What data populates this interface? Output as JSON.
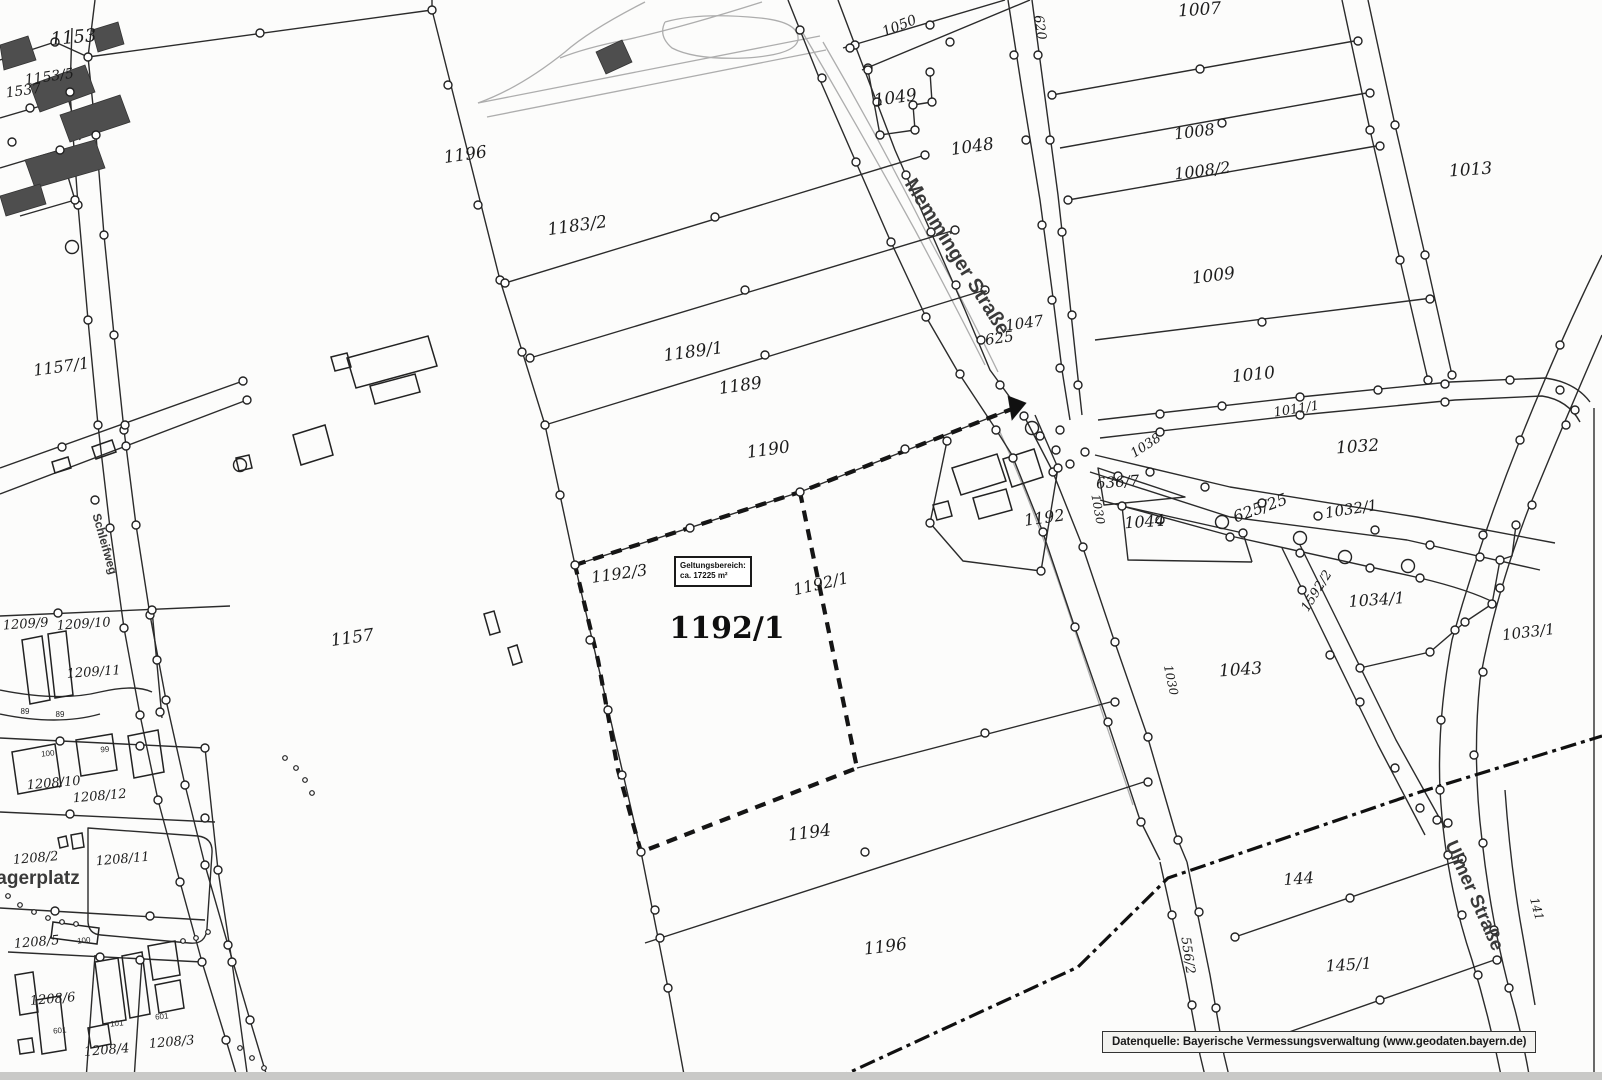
{
  "map": {
    "attribution": "Datenquelle: Bayerische Vermessungsverwaltung (www.geodaten.bayern.de)",
    "geltungsbereich": {
      "line1": "Geltungsbereich:",
      "line2": "ca. 17225 m²"
    },
    "colors": {
      "parcel_line": "#2b2b2b",
      "road_gray": "#adadad",
      "boundary_dashed": "#151515",
      "building_fill": "#4e4e4e"
    },
    "labels": [
      {
        "t": "1153",
        "x": 74,
        "y": 43,
        "r": -5,
        "fs": 18,
        "c": "p"
      },
      {
        "t": "1153/5",
        "x": 50,
        "y": 81,
        "r": -8,
        "fs": 14,
        "c": "p"
      },
      {
        "t": "1537",
        "x": 24,
        "y": 95,
        "r": -8,
        "fs": 14,
        "c": "p"
      },
      {
        "t": "1196",
        "x": 466,
        "y": 160,
        "r": -8,
        "fs": 17,
        "c": "p"
      },
      {
        "t": "1183/2",
        "x": 578,
        "y": 231,
        "r": -8,
        "fs": 17,
        "c": "p"
      },
      {
        "t": "1050",
        "x": 901,
        "y": 30,
        "r": -22,
        "fs": 14,
        "c": "p"
      },
      {
        "t": "1007",
        "x": 1200,
        "y": 15,
        "r": -4,
        "fs": 17,
        "c": "p"
      },
      {
        "t": "1049",
        "x": 896,
        "y": 103,
        "r": -8,
        "fs": 17,
        "c": "p"
      },
      {
        "t": "620",
        "x": 1036,
        "y": 28,
        "r": 82,
        "fs": 13,
        "c": "p"
      },
      {
        "t": "1048",
        "x": 973,
        "y": 152,
        "r": -8,
        "fs": 17,
        "c": "p"
      },
      {
        "t": "1008",
        "x": 1195,
        "y": 137,
        "r": -7,
        "fs": 16,
        "c": "p"
      },
      {
        "t": "1008/2",
        "x": 1203,
        "y": 176,
        "r": -7,
        "fs": 16,
        "c": "p"
      },
      {
        "t": "1013",
        "x": 1471,
        "y": 175,
        "r": -4,
        "fs": 17,
        "c": "p"
      },
      {
        "t": "1009",
        "x": 1214,
        "y": 281,
        "r": -7,
        "fs": 17,
        "c": "p"
      },
      {
        "t": "1010",
        "x": 1254,
        "y": 380,
        "r": -6,
        "fs": 17,
        "c": "p"
      },
      {
        "t": "1047",
        "x": 1025,
        "y": 328,
        "r": -8,
        "fs": 15,
        "c": "p"
      },
      {
        "t": "625",
        "x": 1000,
        "y": 343,
        "r": -8,
        "fs": 15,
        "c": "p"
      },
      {
        "t": "1011/1",
        "x": 1297,
        "y": 413,
        "r": -9,
        "fs": 13,
        "c": "p"
      },
      {
        "t": "1038",
        "x": 1148,
        "y": 449,
        "r": -33,
        "fs": 13,
        "c": "p"
      },
      {
        "t": "1032",
        "x": 1358,
        "y": 452,
        "r": -4,
        "fs": 17,
        "c": "p"
      },
      {
        "t": "625/25",
        "x": 1262,
        "y": 513,
        "r": -20,
        "fs": 16,
        "c": "p"
      },
      {
        "t": "1032/1",
        "x": 1352,
        "y": 514,
        "r": -9,
        "fs": 15,
        "c": "p"
      },
      {
        "t": "636/7",
        "x": 1118,
        "y": 487,
        "r": -4,
        "fs": 15,
        "c": "p"
      },
      {
        "t": "1044",
        "x": 1145,
        "y": 527,
        "r": -4,
        "fs": 16,
        "c": "p"
      },
      {
        "t": "1592/2",
        "x": 1320,
        "y": 593,
        "r": -58,
        "fs": 13,
        "c": "p"
      },
      {
        "t": "1034/1",
        "x": 1377,
        "y": 605,
        "r": -4,
        "fs": 16,
        "c": "p"
      },
      {
        "t": "1033/1",
        "x": 1529,
        "y": 637,
        "r": -7,
        "fs": 15,
        "c": "p"
      },
      {
        "t": "1030",
        "x": 1094,
        "y": 510,
        "r": 80,
        "fs": 12,
        "c": "p"
      },
      {
        "t": "1030",
        "x": 1167,
        "y": 681,
        "r": 78,
        "fs": 12,
        "c": "p"
      },
      {
        "t": "1043",
        "x": 1241,
        "y": 675,
        "r": -4,
        "fs": 17,
        "c": "p"
      },
      {
        "t": "1192",
        "x": 1045,
        "y": 523,
        "r": -8,
        "fs": 16,
        "c": "p"
      },
      {
        "t": "1192/3",
        "x": 620,
        "y": 579,
        "r": -8,
        "fs": 16,
        "c": "p"
      },
      {
        "t": "1192/1",
        "x": 727,
        "y": 638,
        "r": 0,
        "fs": 30,
        "c": "pb"
      },
      {
        "t": "1192/1",
        "x": 822,
        "y": 589,
        "r": -13,
        "fs": 16,
        "c": "p"
      },
      {
        "t": "1157",
        "x": 353,
        "y": 643,
        "r": -8,
        "fs": 17,
        "c": "p"
      },
      {
        "t": "1157/1",
        "x": 62,
        "y": 372,
        "r": -8,
        "fs": 16,
        "c": "p"
      },
      {
        "t": "1209/9",
        "x": 26,
        "y": 628,
        "r": -4,
        "fs": 13,
        "c": "p"
      },
      {
        "t": "1209/10",
        "x": 84,
        "y": 628,
        "r": -4,
        "fs": 13,
        "c": "p"
      },
      {
        "t": "1209/11",
        "x": 94,
        "y": 676,
        "r": -4,
        "fs": 13,
        "c": "p"
      },
      {
        "t": "89",
        "x": 25,
        "y": 714,
        "r": 0,
        "fs": 8,
        "c": "b"
      },
      {
        "t": "89",
        "x": 60,
        "y": 717,
        "r": 0,
        "fs": 8,
        "c": "b"
      },
      {
        "t": "1208/10",
        "x": 54,
        "y": 787,
        "r": -5,
        "fs": 13,
        "c": "p"
      },
      {
        "t": "1208/12",
        "x": 100,
        "y": 800,
        "r": -5,
        "fs": 13,
        "c": "p"
      },
      {
        "t": "1208/2",
        "x": 36,
        "y": 862,
        "r": -5,
        "fs": 13,
        "c": "p"
      },
      {
        "t": "1208/11",
        "x": 123,
        "y": 863,
        "r": -5,
        "fs": 13,
        "c": "p"
      },
      {
        "t": "agerplatz",
        "x": 38,
        "y": 884,
        "r": 0,
        "fs": 19,
        "c": "st"
      },
      {
        "t": "1208/5",
        "x": 37,
        "y": 946,
        "r": -5,
        "fs": 13,
        "c": "p"
      },
      {
        "t": "100",
        "x": 84,
        "y": 943,
        "r": -5,
        "fs": 8,
        "c": "b"
      },
      {
        "t": "100",
        "x": 48,
        "y": 756,
        "r": -5,
        "fs": 8,
        "c": "b"
      },
      {
        "t": "99",
        "x": 105,
        "y": 752,
        "r": -5,
        "fs": 8,
        "c": "b"
      },
      {
        "t": "1208/6",
        "x": 53,
        "y": 1003,
        "r": -5,
        "fs": 13,
        "c": "p"
      },
      {
        "t": "1208/4",
        "x": 107,
        "y": 1054,
        "r": -5,
        "fs": 13,
        "c": "p"
      },
      {
        "t": "1208/3",
        "x": 172,
        "y": 1046,
        "r": -5,
        "fs": 13,
        "c": "p"
      },
      {
        "t": "601",
        "x": 162,
        "y": 1019,
        "r": -5,
        "fs": 8,
        "c": "b"
      },
      {
        "t": "101",
        "x": 117,
        "y": 1026,
        "r": -5,
        "fs": 8,
        "c": "b"
      },
      {
        "t": "601",
        "x": 60,
        "y": 1033,
        "r": -5,
        "fs": 8,
        "c": "b"
      },
      {
        "t": "1194",
        "x": 810,
        "y": 838,
        "r": -7,
        "fs": 17,
        "c": "p"
      },
      {
        "t": "1196",
        "x": 886,
        "y": 952,
        "r": -7,
        "fs": 17,
        "c": "p"
      },
      {
        "t": "556/2",
        "x": 1184,
        "y": 956,
        "r": 82,
        "fs": 13,
        "c": "p"
      },
      {
        "t": "144",
        "x": 1299,
        "y": 884,
        "r": -4,
        "fs": 16,
        "c": "p"
      },
      {
        "t": "145/1",
        "x": 1349,
        "y": 970,
        "r": -4,
        "fs": 16,
        "c": "p"
      },
      {
        "t": "141",
        "x": 1533,
        "y": 910,
        "r": 75,
        "fs": 12,
        "c": "p"
      },
      {
        "t": "1190",
        "x": 769,
        "y": 455,
        "r": -8,
        "fs": 17,
        "c": "p"
      },
      {
        "t": "1189",
        "x": 741,
        "y": 391,
        "r": -8,
        "fs": 17,
        "c": "p"
      },
      {
        "t": "1189/1",
        "x": 694,
        "y": 357,
        "r": -8,
        "fs": 17,
        "c": "p"
      },
      {
        "t": "Memminger Straße",
        "x": 952,
        "y": 260,
        "r": 58,
        "fs": 20,
        "c": "st"
      },
      {
        "t": "Ulmer Straße",
        "x": 1469,
        "y": 898,
        "r": 66,
        "fs": 19,
        "c": "st"
      },
      {
        "t": "Schleifweg",
        "x": 101,
        "y": 545,
        "r": 74,
        "fs": 12,
        "c": "st"
      }
    ]
  }
}
